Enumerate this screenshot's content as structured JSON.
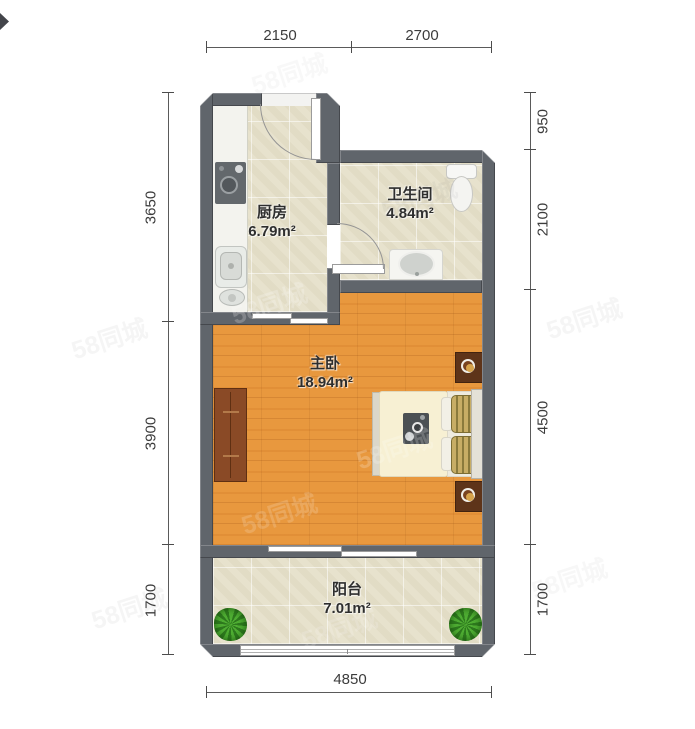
{
  "watermark": {
    "text": "58同城"
  },
  "rooms": {
    "kitchen": {
      "name": "厨房",
      "area": "6.79",
      "unit": "m²"
    },
    "bathroom": {
      "name": "卫生间",
      "area": "4.84",
      "unit": "m²"
    },
    "bedroom": {
      "name": "主卧",
      "area": "18.94",
      "unit": "m²"
    },
    "balcony": {
      "name": "阳台",
      "area": "7.01",
      "unit": "m²"
    }
  },
  "dims": {
    "top": [
      "2150",
      "2700"
    ],
    "bottom": [
      "4850"
    ],
    "left": [
      "3650",
      "3900",
      "1700"
    ],
    "right": [
      "950",
      "2100",
      "4500",
      "1700"
    ]
  },
  "colors": {
    "wall": "#60656b",
    "wood_floor": "#e8983e",
    "tile_floor": "#e7e2cd",
    "wardrobe": "#8a4a26",
    "nightstand": "#5e3419",
    "lamp": "#d7a44c",
    "plant": "#3a8f26",
    "dimension_text": "#3c3c3c"
  }
}
